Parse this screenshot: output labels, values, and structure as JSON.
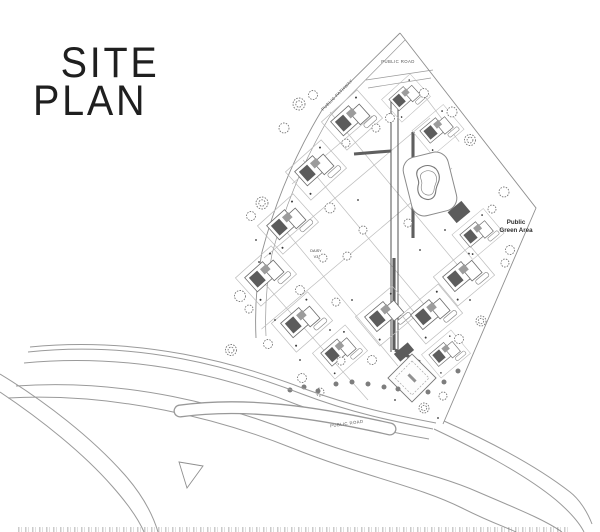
{
  "title": {
    "line1": "SITE",
    "line2": "PLAN"
  },
  "plan": {
    "labels": {
      "public_road_top": "PUBLIC ROAD",
      "public_pathway": "PUBLIC PATHWAY",
      "green_area_1": "Public",
      "green_area_2": "Green Area",
      "villa_1": "DAISY",
      "villa_1_type": "V3",
      "public_road_bottom": "PUBLIC ROAD"
    },
    "colors": {
      "ink": "#1f1f1f",
      "boundary_line": "#8f8f8f",
      "lot_line": "#bcbcbc",
      "roof_dark": "#5c5c5c",
      "roof_mid": "#9c9c9c",
      "background": "#ffffff"
    }
  }
}
